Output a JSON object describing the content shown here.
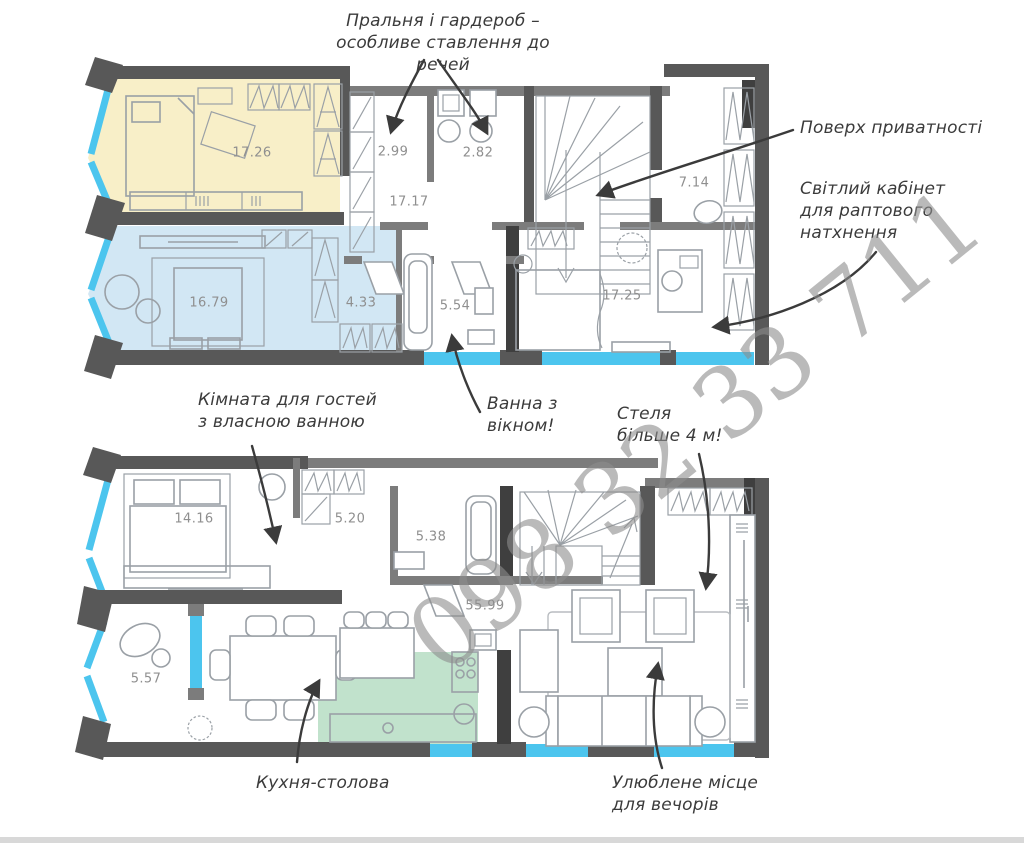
{
  "watermark": {
    "text": "098 32 33 711",
    "color": "#8d8d8d"
  },
  "palette": {
    "wall_dark": "#585858",
    "wall_medium": "#7c7c7c",
    "wall_black": "#3f3f3f",
    "window_glazing": "#4cc5ee",
    "room_fill_yellow": "#f8efc8",
    "room_fill_blue": "#d2e7f4",
    "room_fill_green": "#c1e2cc",
    "furniture_line": "#9aa0a6",
    "area_label_text": "#8f8f8f",
    "annotation_text": "#3b3b3b"
  },
  "annotations": {
    "laundry": [
      "Пральня і гардероб –",
      "особливе ставлення до речей"
    ],
    "privacy": [
      "Поверх приватності"
    ],
    "office": [
      "Світлий кабінет",
      "для раптового",
      "натхнення"
    ],
    "guest": [
      "Кімната для гостей",
      "з власною ванною"
    ],
    "bath": [
      "Ванна з",
      "вікном!"
    ],
    "ceiling": [
      "Стеля",
      "більше 4 м!"
    ],
    "kitchen": [
      "Кухня-столова"
    ],
    "evenings": [
      "Улюблене місце",
      "для вечорів"
    ]
  },
  "rooms": {
    "upper": [
      {
        "id": "bedroom-yellow",
        "area": "17.26"
      },
      {
        "id": "wardrobe",
        "area": "2.99"
      },
      {
        "id": "laundry",
        "area": "2.82"
      },
      {
        "id": "corridor",
        "area": "17.17"
      },
      {
        "id": "hall-privacy",
        "area": "7.14"
      },
      {
        "id": "bedroom-master",
        "area": "16.79"
      },
      {
        "id": "wardrobe-master",
        "area": "4.33"
      },
      {
        "id": "bathroom-window",
        "area": "5.54"
      },
      {
        "id": "office-bedroom",
        "area": "17.25"
      }
    ],
    "lower": [
      {
        "id": "guest-bedroom",
        "area": "14.16"
      },
      {
        "id": "hall",
        "area": "5.20"
      },
      {
        "id": "bathroom",
        "area": "5.38"
      },
      {
        "id": "living-kitchen",
        "area": "55.99"
      },
      {
        "id": "balcony",
        "area": "5.57"
      }
    ]
  }
}
